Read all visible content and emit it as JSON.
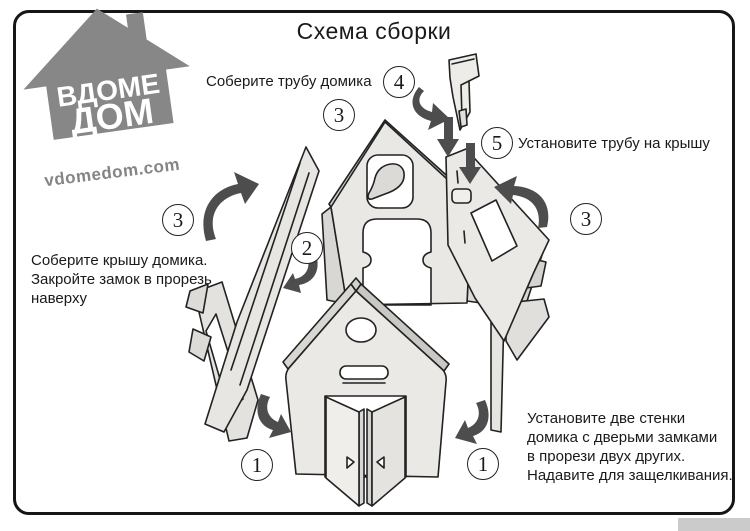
{
  "title": "Схема сборки",
  "logo": {
    "line1": "ВДОМЕ",
    "line2": "ДОМ",
    "website": "vdomedom.com"
  },
  "steps": {
    "step1_left": "1",
    "step1_right": "1",
    "step2": "2",
    "step3_left": "3",
    "step3_top": "3",
    "step3_right": "3",
    "step4": "4",
    "step5": "5"
  },
  "instructions": {
    "assemble_chimney": "Соберите трубу домика",
    "install_chimney": "Установите трубу на крышу",
    "assemble_roof": [
      "Соберите крышу домика.",
      "Закройте замок в прорезь",
      "наверху"
    ],
    "install_walls": [
      "Установите две стенки",
      "домика с дверьми замками",
      "в прорези двух других.",
      "Надавите для защелкивания."
    ]
  },
  "colors": {
    "outline": "#222222",
    "part_fill": "#eae9e5",
    "part_shade": "#d6d5d1",
    "arrow": "#4d4d4d",
    "logo_gray": "#878787",
    "frame_border": "#161616"
  }
}
